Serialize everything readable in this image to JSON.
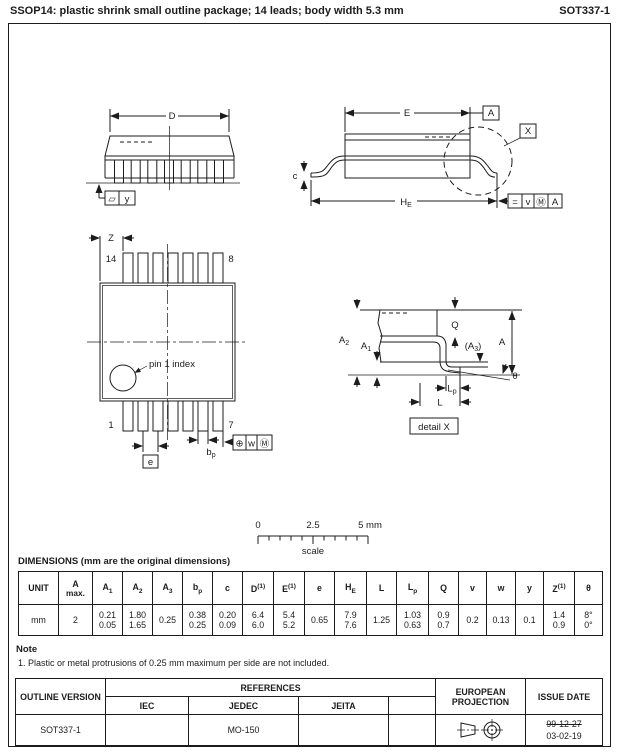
{
  "header": {
    "title": "SSOP14: plastic shrink small outline package; 14 leads; body width 5.3 mm",
    "code": "SOT337-1"
  },
  "side_view": {
    "dim_d": "D",
    "flatness_symbol": "▱",
    "datum_y": "y"
  },
  "end_view": {
    "dim_e": "E",
    "datum_a": "A",
    "detail_ref": "X",
    "dim_c": "c",
    "dim_he_base": "H",
    "dim_he_sub": "E",
    "tol_sym": "=",
    "tol_value": "v",
    "tol_modifier": "Ⓜ",
    "tol_datum": "A"
  },
  "top_view": {
    "dim_z": "Z",
    "pin_14": "14",
    "pin_8": "8",
    "pin_1": "1",
    "pin_7": "7",
    "pin1_note": "pin 1 index",
    "dim_e": "e",
    "dim_bp_base": "b",
    "dim_bp_sub": "p",
    "pos_sym": "⊕",
    "pos_value": "w",
    "pos_modifier": "Ⓜ"
  },
  "detail_view": {
    "dim_a2_base": "A",
    "dim_a2_sub": "2",
    "dim_a1_base": "A",
    "dim_a1_sub": "1",
    "dim_q": "Q",
    "dim_a3_pre": "(A",
    "dim_a3_sub": "3",
    "dim_a3_post": ")",
    "dim_a": "A",
    "dim_theta": "θ",
    "dim_lp_base": "L",
    "dim_lp_sub": "p",
    "dim_l": "L",
    "label": "detail X"
  },
  "scale_bar": {
    "t0": "0",
    "t1": "2.5",
    "t2": "5 mm",
    "label": "scale"
  },
  "dim_table": {
    "caption": "DIMENSIONS (mm are the original dimensions)",
    "columns": [
      {
        "base": "UNIT"
      },
      {
        "base": "A",
        "line2": "max."
      },
      {
        "base": "A",
        "sub": "1"
      },
      {
        "base": "A",
        "sub": "2"
      },
      {
        "base": "A",
        "sub": "3"
      },
      {
        "base": "b",
        "sub": "p"
      },
      {
        "base": "c"
      },
      {
        "base": "D",
        "sup": "(1)"
      },
      {
        "base": "E",
        "sup": "(1)"
      },
      {
        "base": "e"
      },
      {
        "base": "H",
        "sub": "E"
      },
      {
        "base": "L"
      },
      {
        "base": "L",
        "sub": "p"
      },
      {
        "base": "Q"
      },
      {
        "base": "v"
      },
      {
        "base": "w"
      },
      {
        "base": "y"
      },
      {
        "base": "Z",
        "sup": "(1)"
      },
      {
        "base": "θ"
      }
    ],
    "values": [
      [
        "mm"
      ],
      [
        "2"
      ],
      [
        "0.21",
        "0.05"
      ],
      [
        "1.80",
        "1.65"
      ],
      [
        "0.25"
      ],
      [
        "0.38",
        "0.25"
      ],
      [
        "0.20",
        "0.09"
      ],
      [
        "6.4",
        "6.0"
      ],
      [
        "5.4",
        "5.2"
      ],
      [
        "0.65"
      ],
      [
        "7.9",
        "7.6"
      ],
      [
        "1.25"
      ],
      [
        "1.03",
        "0.63"
      ],
      [
        "0.9",
        "0.7"
      ],
      [
        "0.2"
      ],
      [
        "0.13"
      ],
      [
        "0.1"
      ],
      [
        "1.4",
        "0.9"
      ],
      [
        "8°",
        "0°"
      ]
    ]
  },
  "note": {
    "heading": "Note",
    "item": "1. Plastic or metal protrusions of 0.25 mm maximum per side are not included."
  },
  "footer_table": {
    "outline_version": "OUTLINE VERSION",
    "references": "REFERENCES",
    "iec": "IEC",
    "jedec": "JEDEC",
    "jeita": "JEITA",
    "european_projection": "EUROPEAN PROJECTION",
    "issue_date": "ISSUE DATE",
    "row": {
      "outline_version": "SOT337-1",
      "iec": "",
      "jedec": "MO-150",
      "jeita": "",
      "extra": "",
      "issue_date_old": "99-12-27",
      "issue_date_new": "03-02-19"
    }
  },
  "colors": {
    "line": "#1c1c1c",
    "background": "#ffffff"
  }
}
